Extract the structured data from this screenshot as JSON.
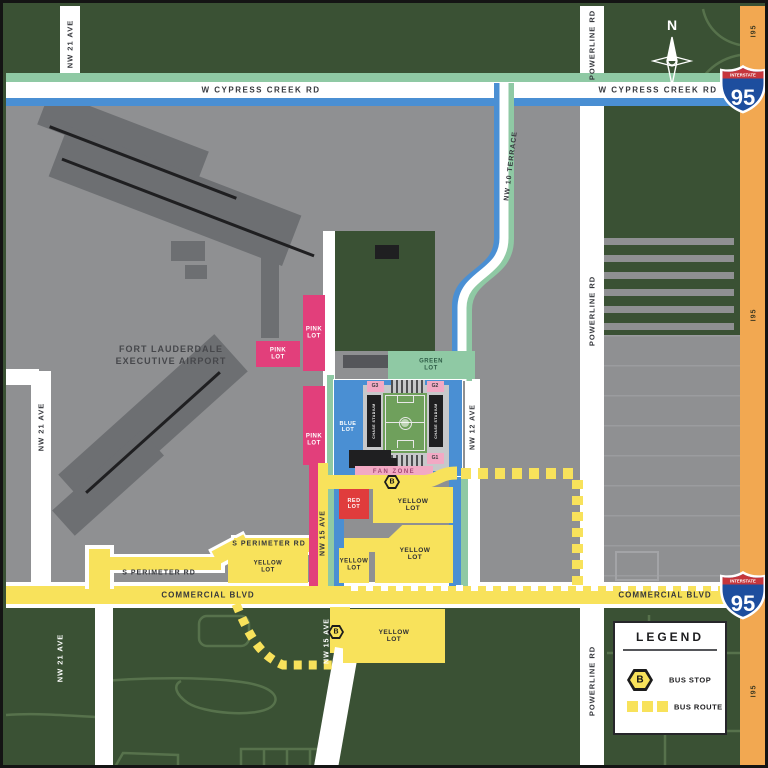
{
  "labels": {
    "nw21": "NW 21 AVE",
    "powerline": "POWERLINE RD",
    "cypress": "W CYPRESS CREEK RD",
    "commercial": "COMMERCIAL BLVD",
    "s_perimeter": "S PERIMETER RD",
    "nw10": "NW 10 TERRACE",
    "nw12": "NW 12 AVE",
    "nw15": "NW 15 AVE",
    "i95": "I95",
    "north": "N"
  },
  "airport": {
    "line1": "FORT LAUDERDALE",
    "line2": "EXECUTIVE AIRPORT"
  },
  "lots": {
    "pink": "PINK LOT",
    "blue": "BLUE LOT",
    "green": "GREEN LOT",
    "red": "RED LOT",
    "yellow": "YELLOW LOT",
    "fan_zone": "FAN ZONE"
  },
  "gates": {
    "g1": "G1",
    "g2": "G2",
    "g3": "G3"
  },
  "stadium": {
    "stand": "CHASE STADIUM"
  },
  "legend": {
    "title": "LEGEND",
    "bus_stop": "BUS STOP",
    "bus_route": "BUS ROUTE",
    "b": "B"
  },
  "shield": {
    "banner": "INTERSTATE",
    "number": "95"
  },
  "colors": {
    "background_green": "#3a5134",
    "airport_gray": "#8f9092",
    "dark_gray": "#6d6f72",
    "building_black": "#1f1f21",
    "road_white": "#ffffff",
    "route_yellow": "#f8e25b",
    "route_blue": "#4a8fd3",
    "route_green": "#8fc9a4",
    "lot_pink": "#e23f7b",
    "lot_red": "#e03c3c",
    "gate_pink": "#f2a9c4",
    "i95_orange": "#f2a851",
    "shield_blue": "#1d4e9e",
    "shield_red": "#c6363c",
    "field_green": "#6fa05c"
  }
}
